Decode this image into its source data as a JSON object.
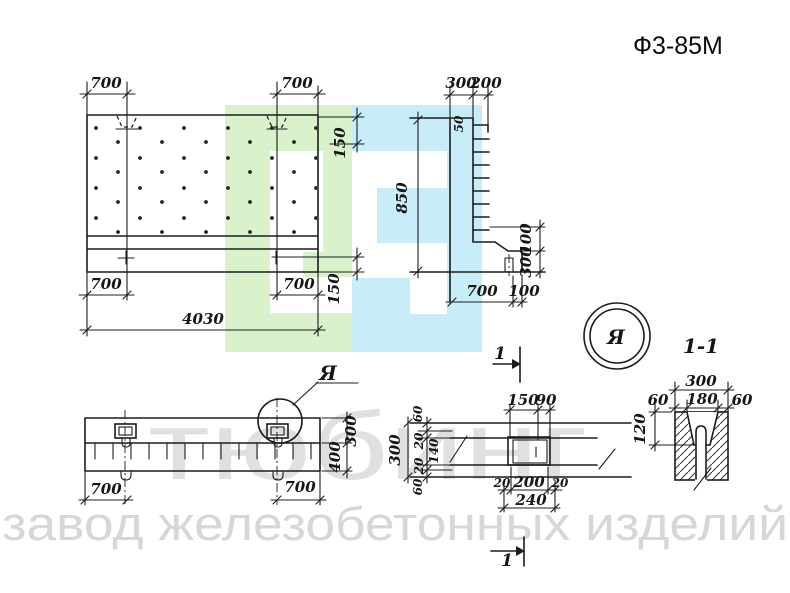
{
  "title": "Ф3-85М",
  "colors": {
    "line": "#1c1c1c",
    "watermark_green": "#d9f2cc",
    "watermark_cyan": "#c9edf8",
    "watermark_text": "#e0e0e0",
    "watermark_text_bottom": "#d7d7d7",
    "paper": "#ffffff"
  },
  "watermark": {
    "word": "тюбинг",
    "bottom_line": "завод железобетонных изделий"
  },
  "panel_view": {
    "top_left_700": "700",
    "top_right_700": "700",
    "right_top_150": "150",
    "right_bottom_150": "150",
    "bottom_left_700": "700",
    "bottom_right_700": "700",
    "total_4030": "4030"
  },
  "profile_view": {
    "w300": "300",
    "w200": "200",
    "lip50": "50",
    "h850": "850",
    "b700": "700",
    "b100": "100",
    "r100": "100",
    "r300": "300"
  },
  "beam_view": {
    "r300": "300",
    "r400": "400",
    "b700_left": "700",
    "b700_right": "700",
    "detail_label": "Я"
  },
  "plan_view": {
    "t150": "150",
    "t90": "90",
    "l60a": "60",
    "l20a": "20",
    "l140": "140",
    "l20b": "20",
    "l60b": "60",
    "l300": "300",
    "b20a": "20",
    "b200": "200",
    "b20b": "20",
    "b240": "240",
    "cut_mark_top": "1",
    "cut_mark_bottom": "1"
  },
  "section_view": {
    "label": "1-1",
    "w300": "300",
    "w60a": "60",
    "w180": "180",
    "w60b": "60",
    "h120": "120"
  },
  "view_marker": {
    "letter": "Я"
  }
}
